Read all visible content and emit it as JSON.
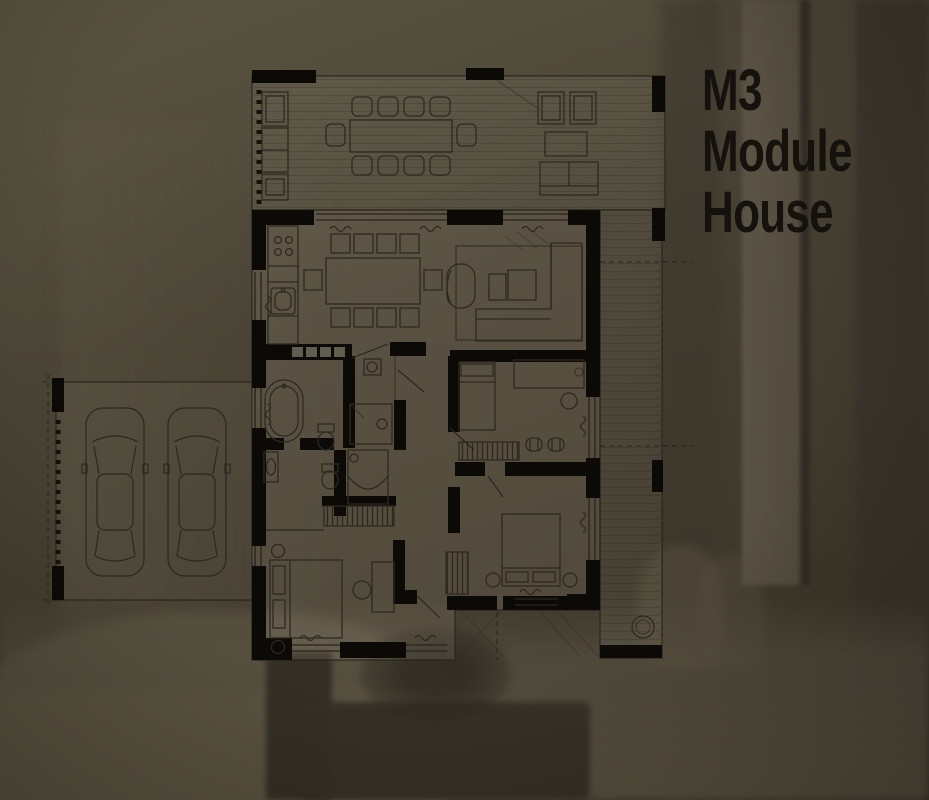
{
  "title": {
    "lines": [
      "M3",
      "Module",
      "House"
    ]
  },
  "colors": {
    "background": "#47412f",
    "wall_fill": "#0b0a07",
    "plan_line": "#27221b",
    "furniture_line": "#2e2920",
    "title_text": "#15110c",
    "plan_tint": "rgba(205,195,172,0.12)"
  },
  "plan": {
    "areas": [
      "terrace",
      "living-dining-kitchen",
      "bathroom-main",
      "bathroom-second",
      "bedroom-middle",
      "bedroom-bottom-left",
      "bedroom-bottom-right",
      "hallway",
      "carport",
      "side-deck"
    ],
    "furniture": [
      "outdoor-dining-table",
      "outdoor-chairs",
      "outdoor-lounge-set",
      "kitchen-counter",
      "dining-table",
      "dining-chairs",
      "armchair",
      "coffee-table",
      "corner-sofa",
      "bathtub",
      "toilet",
      "shower",
      "sink",
      "washing-machine",
      "double-bed",
      "wardrobe",
      "desk",
      "car",
      "fire-pit"
    ]
  }
}
